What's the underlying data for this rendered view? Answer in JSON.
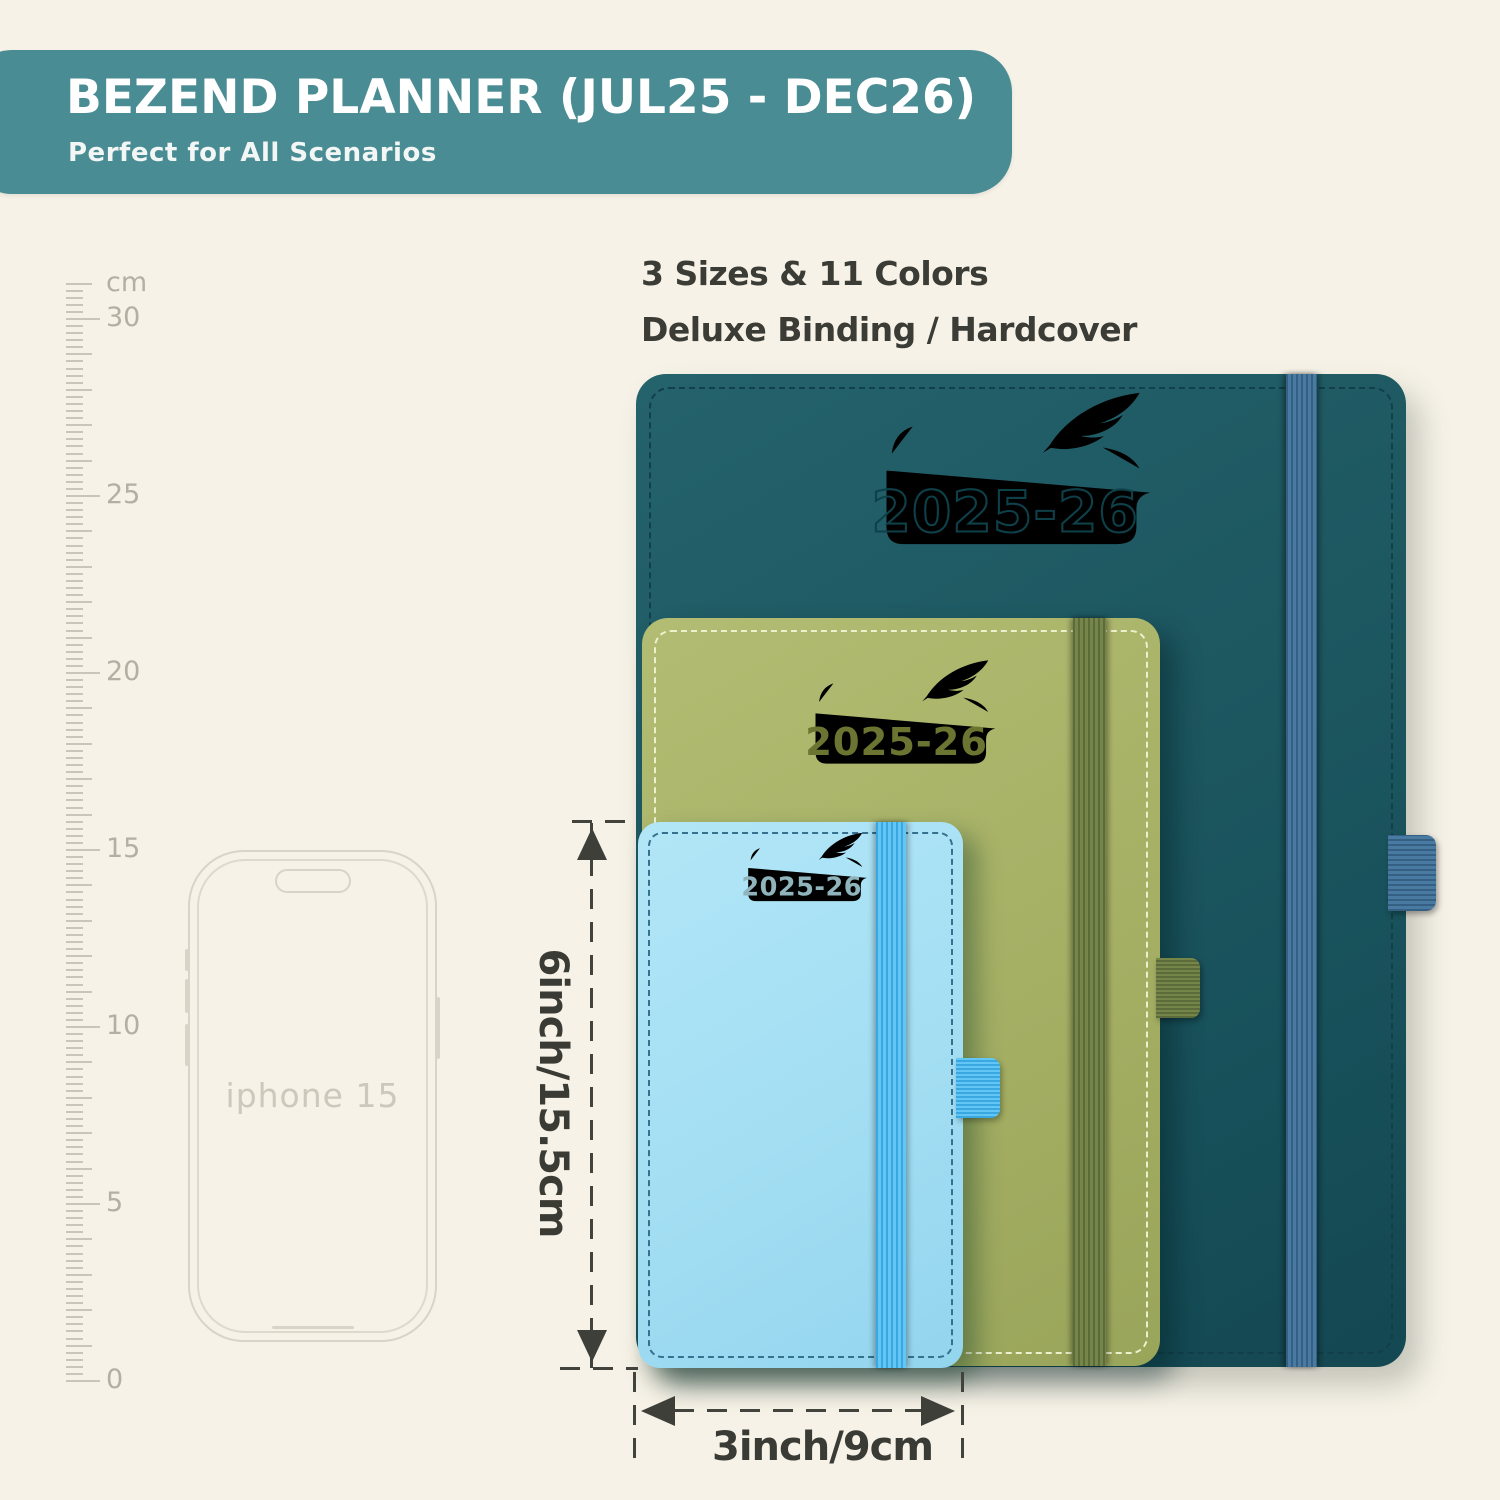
{
  "banner": {
    "title": "BEZEND PLANNER (JUL25 - DEC26)",
    "subtitle": "Perfect for All Scenarios",
    "bg_color": "#4a8c93",
    "text_color": "#ffffff"
  },
  "features": {
    "line1": "3 Sizes & 11 Colors",
    "line2": "Deluxe Binding / Hardcover"
  },
  "ruler": {
    "unit": "cm",
    "max_cm": 31,
    "label_values": [
      30,
      25,
      20,
      15,
      10,
      5,
      0
    ]
  },
  "phone": {
    "label": "iphone 15"
  },
  "planners": [
    {
      "size": "large",
      "year": "2025-26",
      "cover_color": "#1d5760",
      "band_color": "#3f6f94"
    },
    {
      "size": "medium",
      "year": "2025-26",
      "cover_color": "#a7b166",
      "band_color": "#6e7d49"
    },
    {
      "size": "small",
      "year": "2025-26",
      "cover_color": "#a3def3",
      "band_color": "#49b7ea"
    }
  ],
  "dimensions": {
    "height_label": "6inch/15.5cm",
    "width_label": "3inch/9cm"
  }
}
